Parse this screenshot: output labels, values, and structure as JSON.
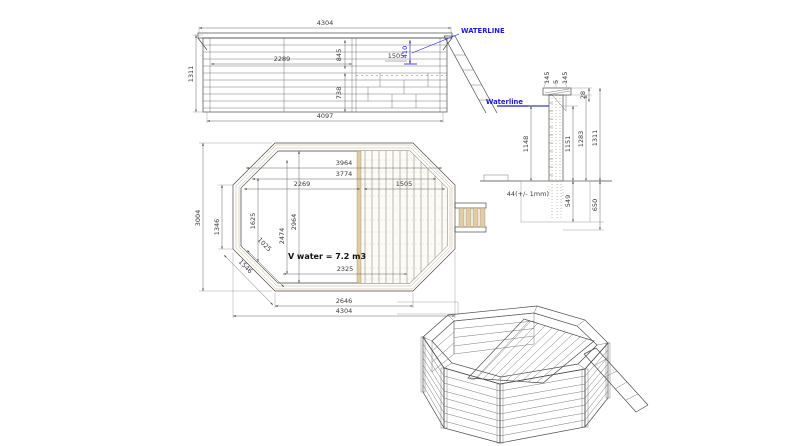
{
  "colors": {
    "accent_blue": "#1a1ad2",
    "wood": "#dfcda8",
    "wood_ring": "#ead9bb",
    "line": "#4a4a4a",
    "dim_text": "#3a3a3a"
  },
  "elevation": {
    "dim_overall_width": "4304",
    "dim_overall_height": "1311",
    "dim_inner_left": "2289",
    "dim_depth_top": "845",
    "dim_deck": "1505",
    "dim_waterline_offset": "410",
    "dim_depth_bottom": "738",
    "dim_base_width": "4097",
    "waterline_label": "WATERLINE"
  },
  "plan": {
    "dim_inner_width": "3964",
    "dim_water_width": "3774",
    "dim_left_to_deck": "2269",
    "dim_deck_width": "1505",
    "dim_inner_height": "2964",
    "dim_water_height": "2474",
    "dim_left_opening": "1625",
    "dim_corner_inner": "1025",
    "dim_side_flat": "1346",
    "dim_corner_outer": "1546",
    "dim_overall_height": "3004",
    "dim_floor_width": "2325",
    "dim_bottom_flat": "2646",
    "dim_overall_width": "4304",
    "volume_label": "V water = 7.2 m3"
  },
  "section": {
    "dim_cap_front": "145",
    "dim_cap_gap": "5",
    "dim_cap_back": "145",
    "dim_cap_rise": "28",
    "waterline_label": "Waterline",
    "dim_water_depth": "1148",
    "dim_wall_inner": "1151",
    "dim_wall_upper": "1283",
    "dim_wall_total": "1311",
    "dim_buried": "549",
    "dim_foundation": "650",
    "wall_thickness_label": "44(+/- 1mm)"
  }
}
